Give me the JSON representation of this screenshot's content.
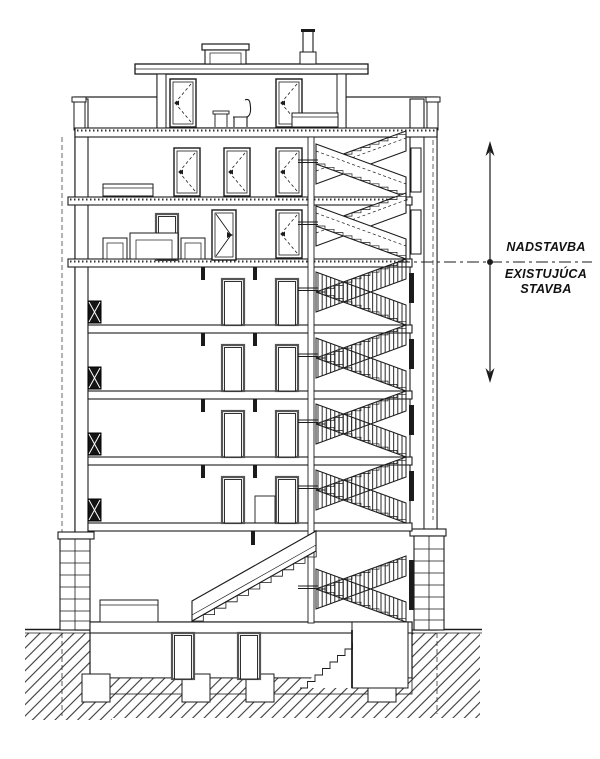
{
  "drawing": {
    "kind": "building cross-section",
    "annotation": {
      "upper_label": "NADSTAVBA",
      "lower_label_line1": "EXISTUJÚCA",
      "lower_label_line2": "STAVBA"
    },
    "levels": {
      "penthouse": 1,
      "superstructure_floors": 2,
      "existing_floors": 5,
      "basement": 1
    },
    "colors": {
      "line": "#1b1b1b",
      "background": "#ffffff"
    }
  }
}
